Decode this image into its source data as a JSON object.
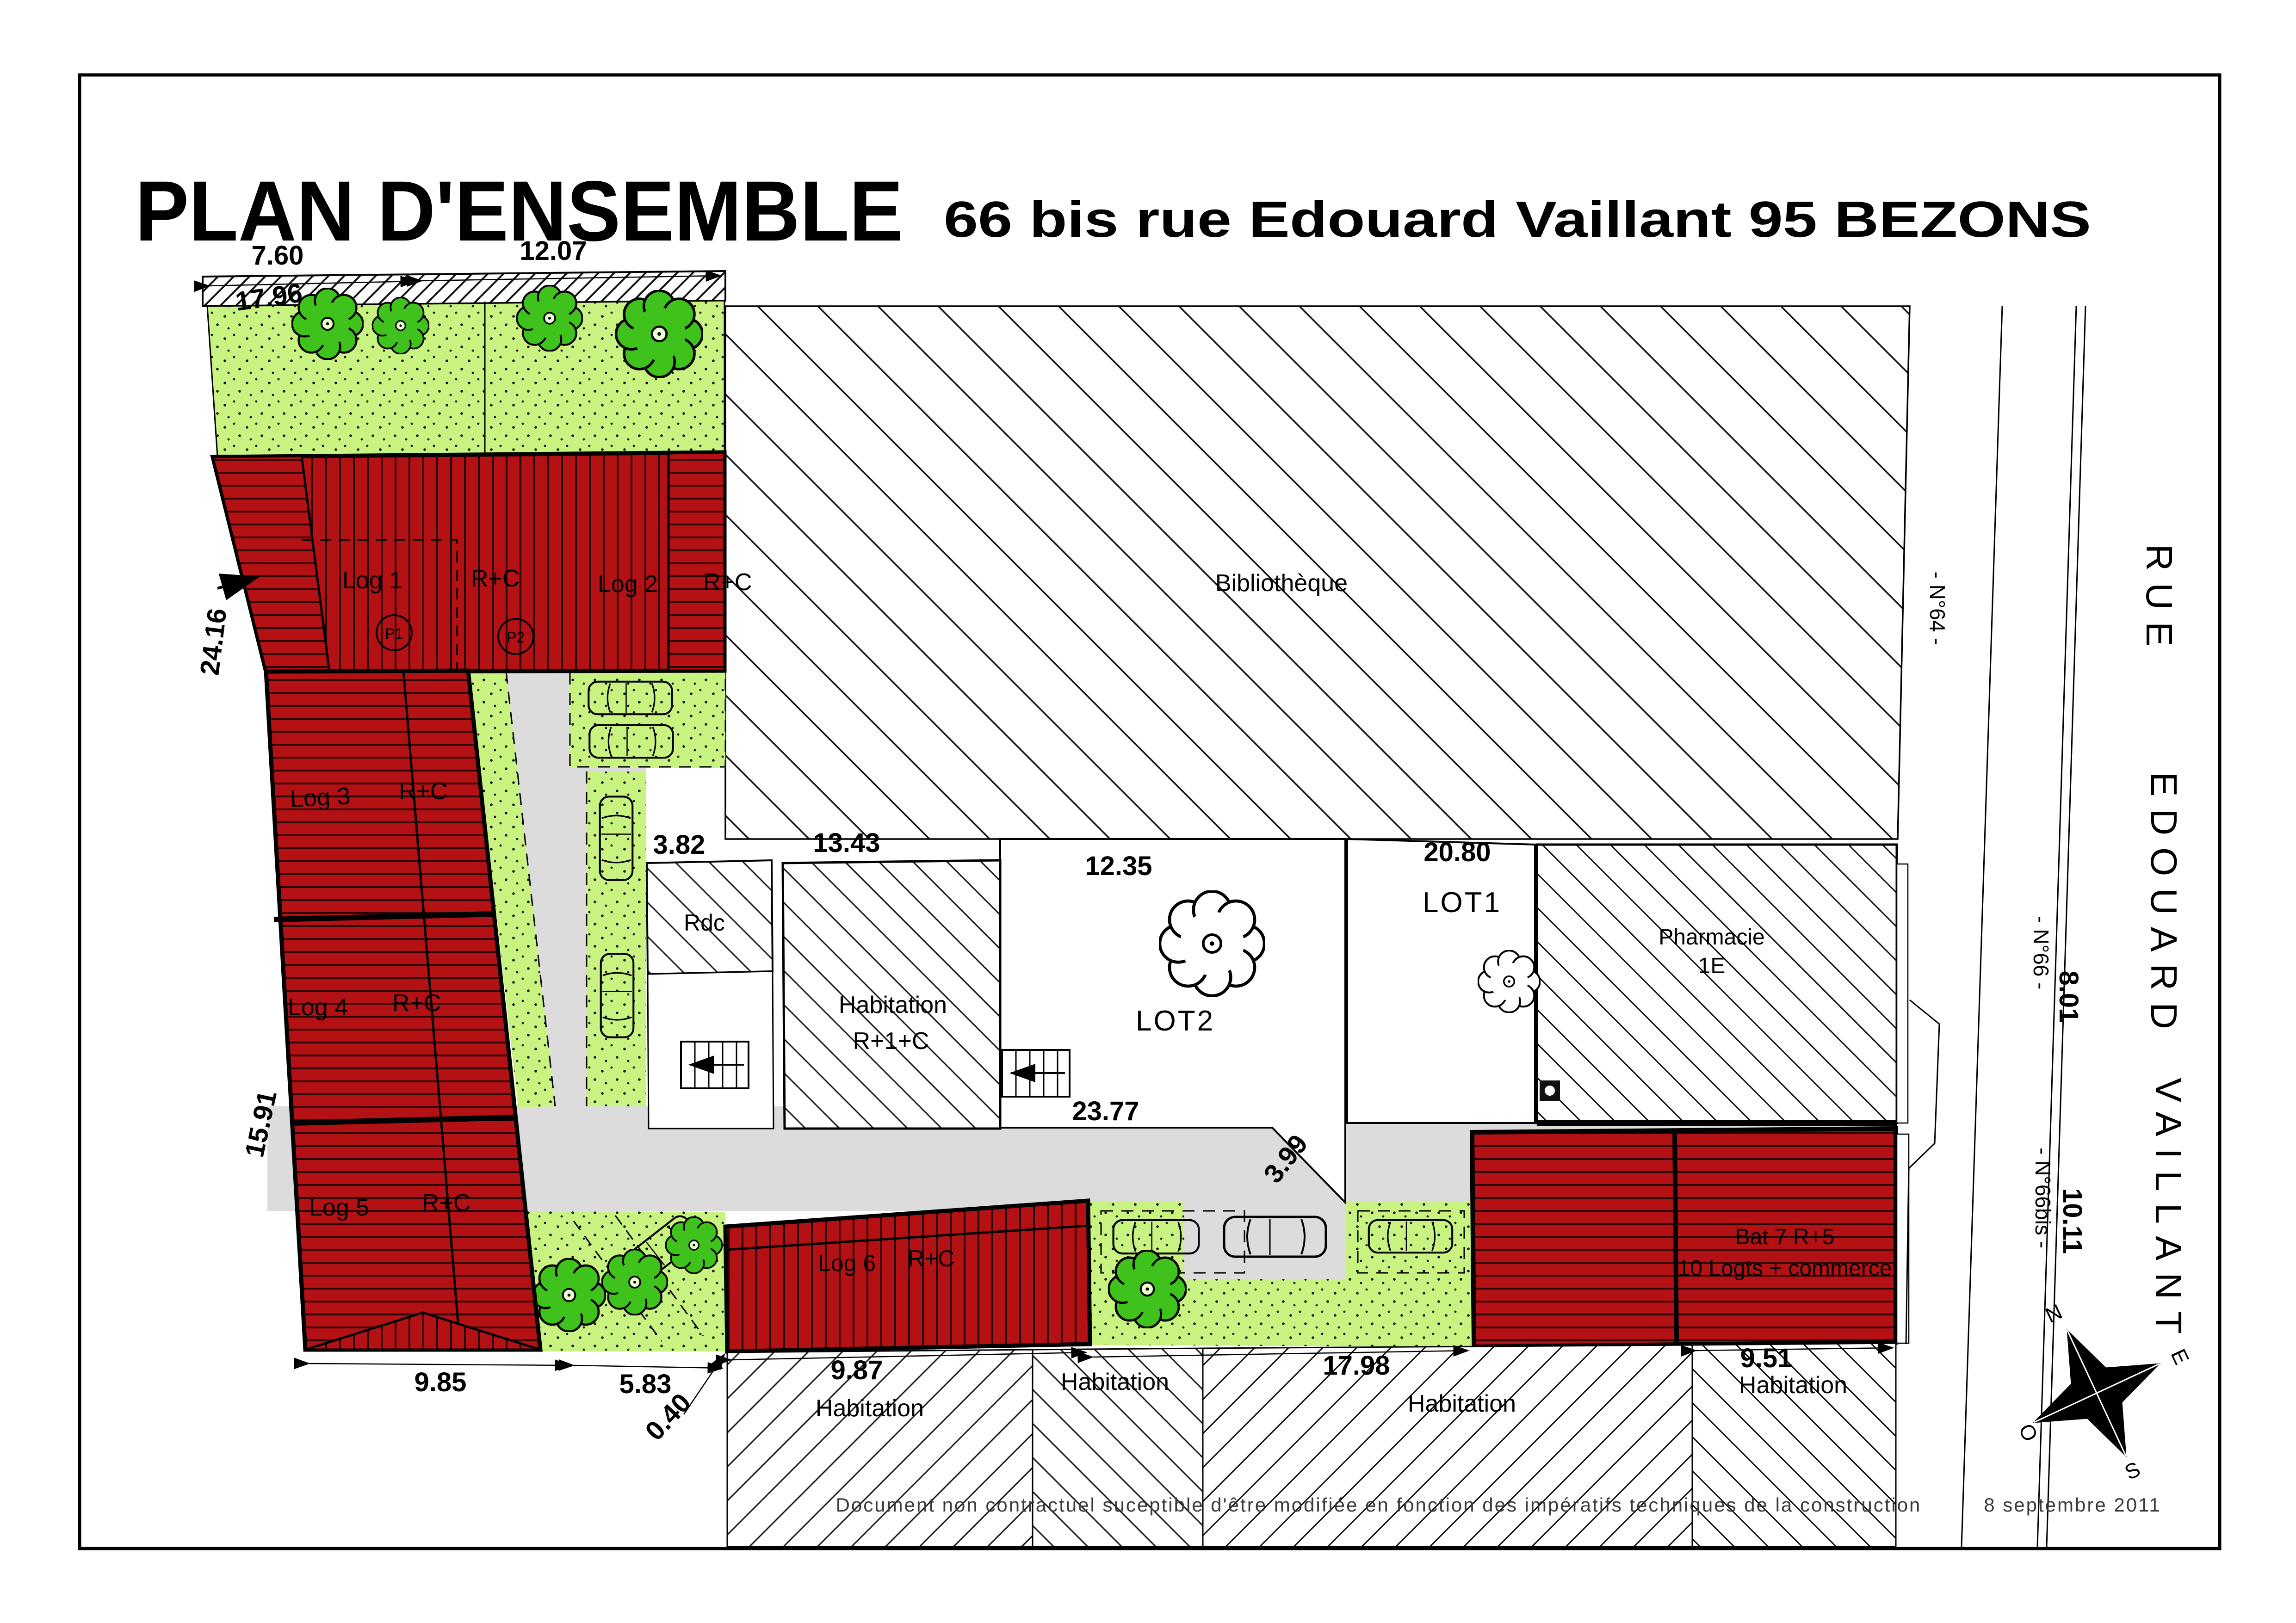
{
  "title": {
    "main": "PLAN D'ENSEMBLE",
    "subtitle": "66 bis rue Edouard Vaillant 95 BEZONS"
  },
  "buildings": {
    "log1": {
      "name": "Log 1",
      "floors": "R+C",
      "parking": "P1"
    },
    "log2": {
      "name": "Log 2",
      "floors": "R+C",
      "parking": "P2"
    },
    "log3": {
      "name": "Log 3",
      "floors": "R+C"
    },
    "log4": {
      "name": "Log 4",
      "floors": "R+C"
    },
    "log5": {
      "name": "Log 5",
      "floors": "R+C"
    },
    "log6": {
      "name": "Log 6",
      "floors": "R+C"
    },
    "bat7": {
      "name": "Bat 7 R+5",
      "desc": "10 Logts + commerce"
    },
    "rdc": {
      "name": "Rdc"
    },
    "habitation_r1c": {
      "line1": "Habitation",
      "line2": "R+1+C"
    },
    "pharmacie": {
      "line1": "Pharmacie",
      "line2": "1E"
    },
    "bibliotheque": {
      "name": "Bibliothèque"
    }
  },
  "lots": {
    "lot1": "LOT1",
    "lot2": "LOT2"
  },
  "neighbors": {
    "h1": "Habitation",
    "h2": "Habitation",
    "h3": "Habitation",
    "h4": "Habitation"
  },
  "dims": {
    "d760": "7.60",
    "d1207": "12.07",
    "d1796": "17.96",
    "d2416": "24.16",
    "d1591": "15.91",
    "d985": "9.85",
    "d583": "5.83",
    "d040": "0.40",
    "d987": "9.87",
    "d382": "3.82",
    "d1343": "13.43",
    "d1235": "12.35",
    "d2080": "20.80",
    "d2377": "23.77",
    "d399": "3.99",
    "d1798": "17.98",
    "d951": "9.51",
    "d801": "8.01",
    "d1011": "10.11"
  },
  "street": {
    "parts": [
      "RUE",
      "EDOUARD",
      "VAILLANT"
    ],
    "n64": "- N°64 -",
    "n66": "- N°66 -",
    "n66bis": "- N°66bis -"
  },
  "compass": {
    "n": "N",
    "e": "E",
    "s": "S",
    "o": "O"
  },
  "footer": {
    "disclaimer": "Document non contractuel suceptible d'être modifiée en fonction des impératifs techniques de la construction",
    "date": "8 septembre 2011"
  },
  "colors": {
    "building_red": "#b31113",
    "lawn_green": "#c9f381",
    "tree_green": "#3fc21c",
    "road_grey": "#dcdcdc",
    "line_black": "#111111"
  }
}
